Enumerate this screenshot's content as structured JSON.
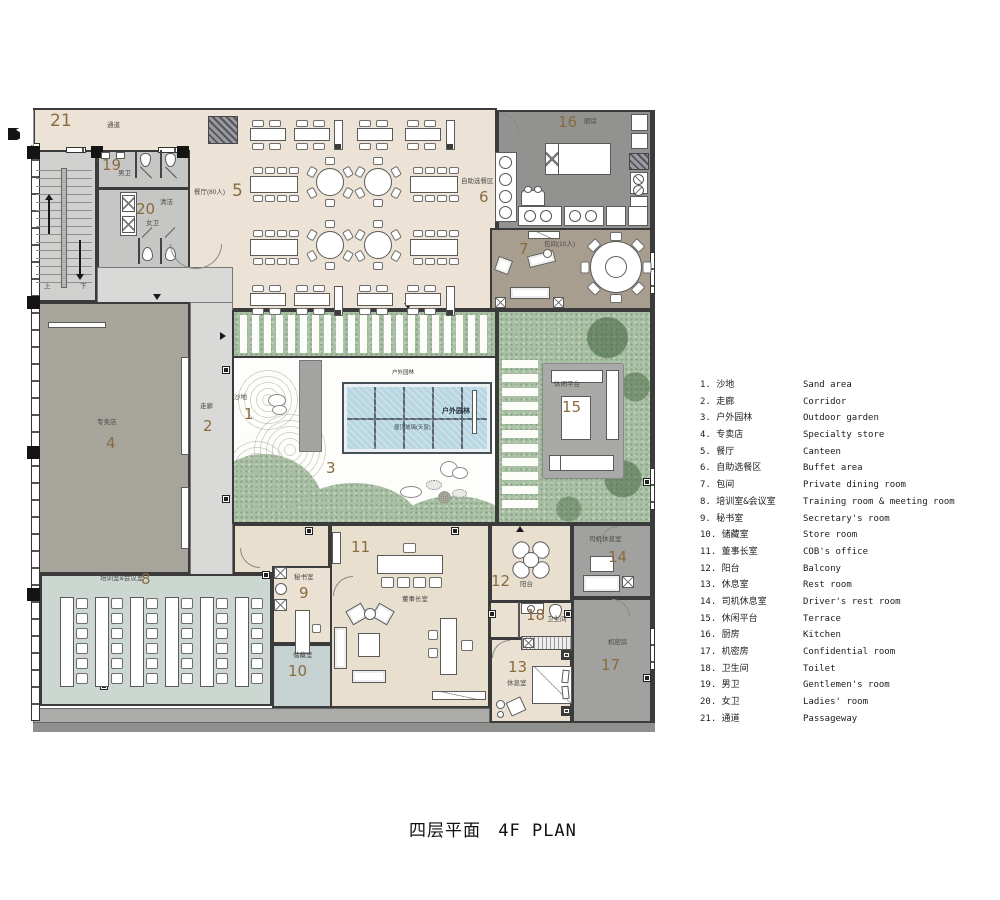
{
  "title": {
    "zh": "四层平面",
    "en": "4F PLAN"
  },
  "legend": {
    "items": [
      {
        "no": "1.",
        "zh": "沙地",
        "en": "Sand area"
      },
      {
        "no": "2.",
        "zh": "走廊",
        "en": "Corridor"
      },
      {
        "no": "3.",
        "zh": "户外园林",
        "en": "Outdoor garden"
      },
      {
        "no": "4.",
        "zh": "专卖店",
        "en": "Specialty store"
      },
      {
        "no": "5.",
        "zh": "餐厅",
        "en": "Canteen"
      },
      {
        "no": "6.",
        "zh": "自助选餐区",
        "en": "Buffet area"
      },
      {
        "no": "7.",
        "zh": "包间",
        "en": "Private dining room"
      },
      {
        "no": "8.",
        "zh": "培训室&会议室",
        "en": "Training room & meeting room"
      },
      {
        "no": "9.",
        "zh": "秘书室",
        "en": "Secretary's room"
      },
      {
        "no": "10.",
        "zh": "储藏室",
        "en": "Store room"
      },
      {
        "no": "11.",
        "zh": "董事长室",
        "en": "COB's office"
      },
      {
        "no": "12.",
        "zh": "阳台",
        "en": "Balcony"
      },
      {
        "no": "13.",
        "zh": "休息室",
        "en": "Rest room"
      },
      {
        "no": "14.",
        "zh": "司机休息室",
        "en": "Driver's rest room"
      },
      {
        "no": "15.",
        "zh": "休闲平台",
        "en": "Terrace"
      },
      {
        "no": "16.",
        "zh": "厨房",
        "en": "Kitchen"
      },
      {
        "no": "17.",
        "zh": "机密房",
        "en": "Confidential room"
      },
      {
        "no": "18.",
        "zh": "卫生间",
        "en": "Toilet"
      },
      {
        "no": "19.",
        "zh": "男卫",
        "en": "Gentlemen's room"
      },
      {
        "no": "20.",
        "zh": "女卫",
        "en": "Ladies' room"
      },
      {
        "no": "21.",
        "zh": "通道",
        "en": "Passageway"
      }
    ]
  },
  "plan": {
    "rooms": [
      {
        "num": "1",
        "zh": "沙地"
      },
      {
        "num": "2",
        "zh": "走廊"
      },
      {
        "num": "3",
        "zh": ""
      },
      {
        "num": "4",
        "zh": "专卖店"
      },
      {
        "num": "5",
        "zh": "餐厅(80人)"
      },
      {
        "num": "6",
        "zh": "自助选餐区"
      },
      {
        "num": "7",
        "zh": "包间(10人)"
      },
      {
        "num": "8",
        "zh": "培训室&会议室"
      },
      {
        "num": "9",
        "zh": "秘书室"
      },
      {
        "num": "10",
        "zh": "储藏室"
      },
      {
        "num": "11",
        "zh": "董事长室"
      },
      {
        "num": "12",
        "zh": "阳台"
      },
      {
        "num": "13",
        "zh": "休息室"
      },
      {
        "num": "14",
        "zh": "司机休息室"
      },
      {
        "num": "15",
        "zh": "休闲平台"
      },
      {
        "num": "16",
        "zh": "厨房"
      },
      {
        "num": "17",
        "zh": "机密房"
      },
      {
        "num": "18",
        "zh": "卫生间"
      },
      {
        "num": "19",
        "zh": "男卫"
      },
      {
        "num": "20",
        "zh": "女卫"
      },
      {
        "num": "21",
        "zh": "通道"
      }
    ],
    "extra": {
      "sky_top": "户外园林",
      "sky_name": "户外园林",
      "sky_sub": "屋顶玻璃(天窗)",
      "clean": "清洁",
      "up": "上",
      "down": "下"
    },
    "colors": {
      "beige": "#ece3d6",
      "taupe": "#a89e90",
      "kitchen_gray": "#929290",
      "store_gray": "#a7a49c",
      "corridor": "#d9d9d7",
      "training": "#ccd7d2",
      "garden_green": "#a9c0a4",
      "skylight_blue": "#b9d6e3",
      "number_brown": "#8a6b3e"
    }
  }
}
